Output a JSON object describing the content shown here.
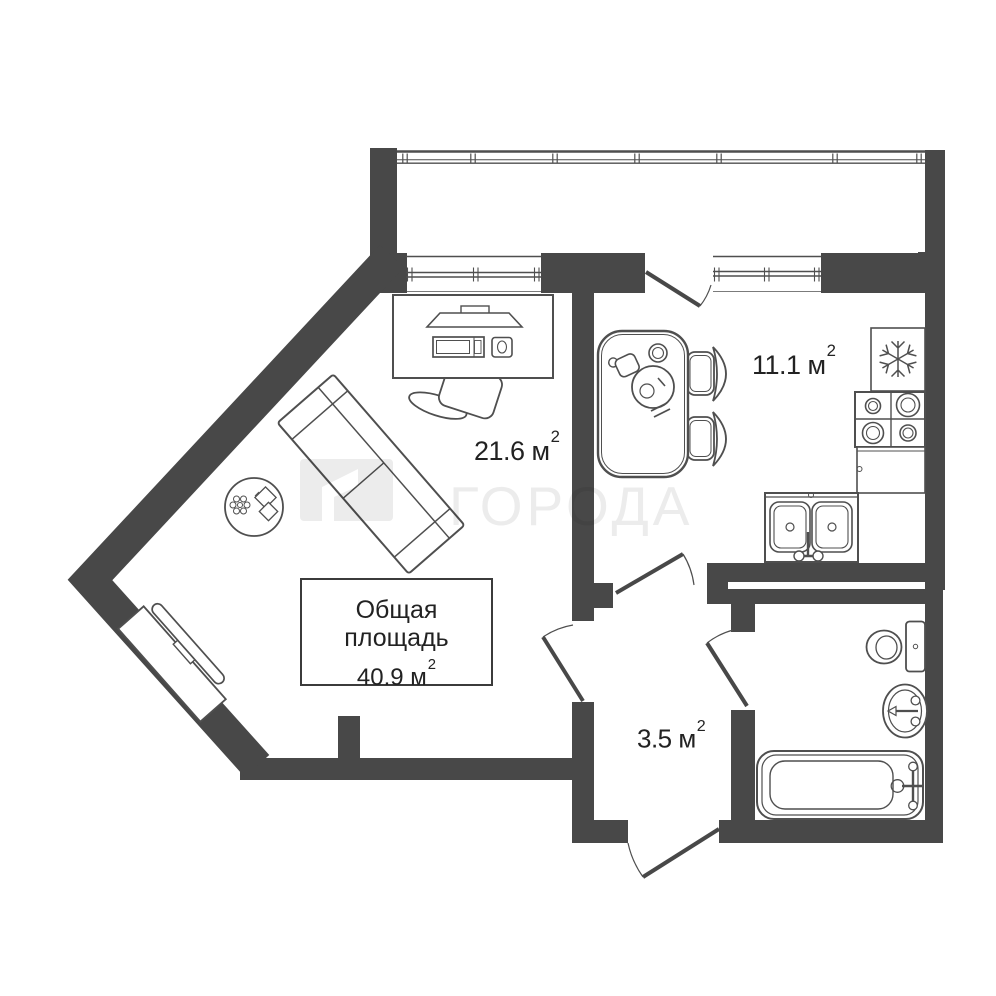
{
  "plan": {
    "background": "#ffffff",
    "wall_color": "#484848",
    "line_color": "#4f4f4f",
    "text_color": "#222222"
  },
  "labels": {
    "living_room": {
      "text": "21.6 м",
      "exp": "2"
    },
    "kitchen": {
      "text": "11.1 м",
      "exp": "2"
    },
    "hallway": {
      "text": "3.5 м",
      "exp": "2"
    }
  },
  "total_area_box": {
    "title": "Общая площадь",
    "text": "40.9 м",
    "exp": "2"
  },
  "watermark": {
    "text": "ГОРОДА",
    "color": "#ececec",
    "logo_color": "#f1f1f1"
  }
}
